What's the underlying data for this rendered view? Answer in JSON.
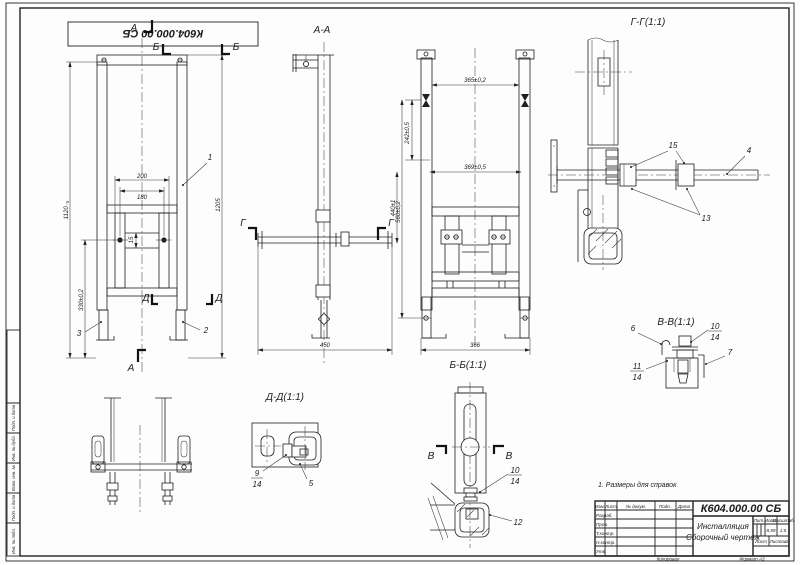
{
  "stamp": {
    "doc_number_rotated": "К604.000.00 СБ"
  },
  "note": "1. Размеры для справок",
  "side_strip": {
    "cells": [
      "Подп. и дата",
      "Инв. № дубл.",
      "Взам. инв. №",
      "Подп. и дата",
      "Инв. № подл."
    ]
  },
  "markers": {
    "a": "А",
    "b": "Б",
    "v": "В",
    "g": "Г",
    "d": "Д"
  },
  "views": {
    "front": {
      "dims": {
        "w200": "200",
        "w180": "180",
        "h1120": "1120₋₅",
        "h330": "330±0,2",
        "h1205": "1205",
        "g15": "15"
      },
      "callouts": {
        "c1": "1",
        "c2": "2",
        "c3": "3"
      }
    },
    "aa": {
      "label": "А-А",
      "dims": {
        "w450": "450",
        "h440": "440±1"
      }
    },
    "bb": {
      "label": "Б-Б(1:1)",
      "dims": {
        "w365": "365±0,2",
        "w369": "369±0,5",
        "h242": "242±0,5",
        "h560": "560±0,2",
        "w366": "366"
      }
    },
    "gg": {
      "label": "Г-Г(1:1)",
      "callouts": {
        "c15": "15",
        "c4": "4",
        "c13": "13"
      }
    },
    "vv": {
      "label": "В-В(1:1)",
      "callouts": {
        "c6": "6",
        "c10": "10",
        "c14a": "14",
        "c7": "7",
        "c11": "11",
        "c14b": "14"
      }
    },
    "dd": {
      "label": "Д-Д(1:1)",
      "callouts": {
        "c9": "9",
        "c14": "14",
        "c5": "5"
      }
    },
    "foot": {
      "callouts": {
        "c10": "10",
        "c14": "14",
        "c12": "12"
      }
    }
  },
  "title_block": {
    "doc_number": "К604.000.00 СБ",
    "name_line1": "Инсталляция",
    "name_line2": "Сборочный чертеж",
    "col_headers": [
      "Изм.",
      "Лист",
      "№ докум.",
      "Подп.",
      "Дата"
    ],
    "row_labels": [
      "Разраб.",
      "Пров.",
      "Т.контр.",
      "Н.контр.",
      "Утв."
    ],
    "lit_header": "Лит.",
    "mass_header": "Масса",
    "scale_header": "Масштаб",
    "mass": "8,59",
    "scale": "1:5",
    "sheet_label": "Лист",
    "sheets_label": "Листов",
    "sheets_value": "1",
    "kopiroval": "Копировал",
    "format": "Формат А3"
  }
}
